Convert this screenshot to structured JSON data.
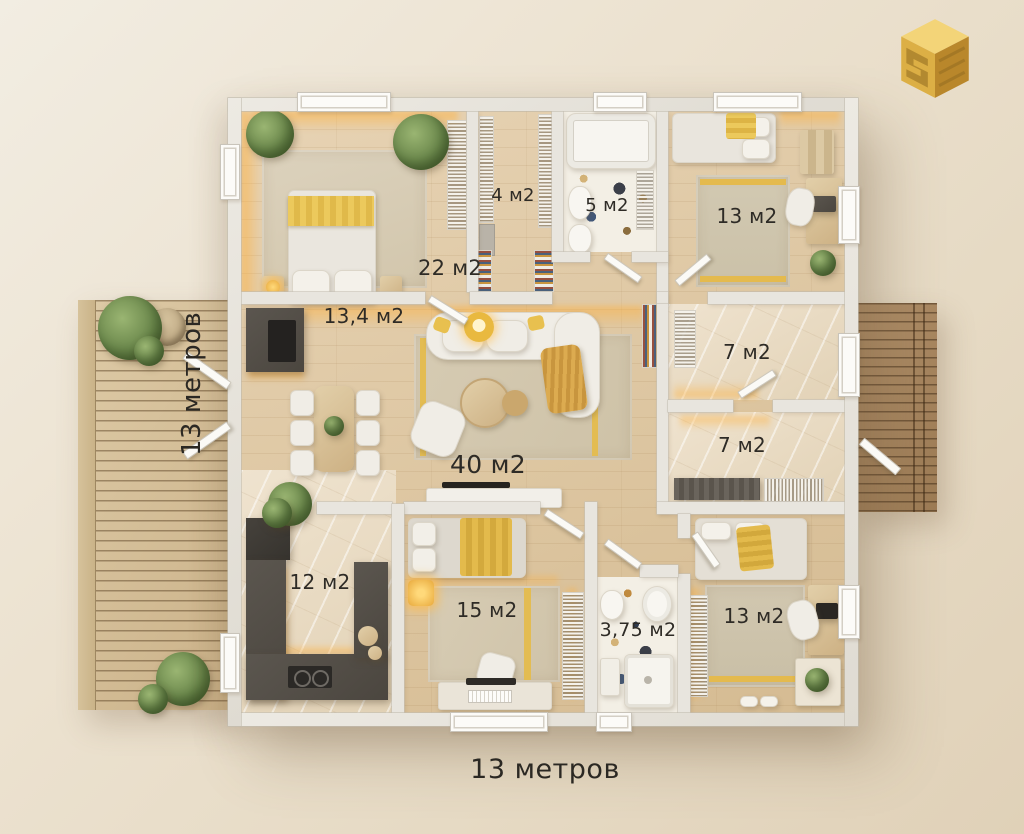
{
  "title": "floor-plan-13x13",
  "dimensions": {
    "horizontal": "13 метров",
    "vertical": "13 метров"
  },
  "rooms": [
    {
      "id": "bedroom-top-left",
      "area": "22 м2"
    },
    {
      "id": "wardrobe",
      "area": "4 м2"
    },
    {
      "id": "bathroom-top",
      "area": "5 м2"
    },
    {
      "id": "bedroom-top-right",
      "area": "13 м2"
    },
    {
      "id": "kitchen-dining",
      "area": "13,4 м2"
    },
    {
      "id": "living-room",
      "area": "40 м2"
    },
    {
      "id": "storage-upper",
      "area": "7 м2"
    },
    {
      "id": "storage-lower",
      "area": "7 м2"
    },
    {
      "id": "kitchen",
      "area": "12 м2"
    },
    {
      "id": "bedroom-bottom-middle",
      "area": "15 м2"
    },
    {
      "id": "bathroom-bottom",
      "area": "3,75 м2"
    },
    {
      "id": "bedroom-bottom-right",
      "area": "13 м2"
    }
  ],
  "colors": {
    "background": "#eae0cc",
    "wall": "#e8e5de",
    "wood_floor": "#ddc6a1",
    "accent_yellow": "#e4ba4e",
    "led_glow": "#ffb03b",
    "counter_dark": "#55504a",
    "logo_gold": "#d9a83c",
    "text": "#2e2b26"
  }
}
